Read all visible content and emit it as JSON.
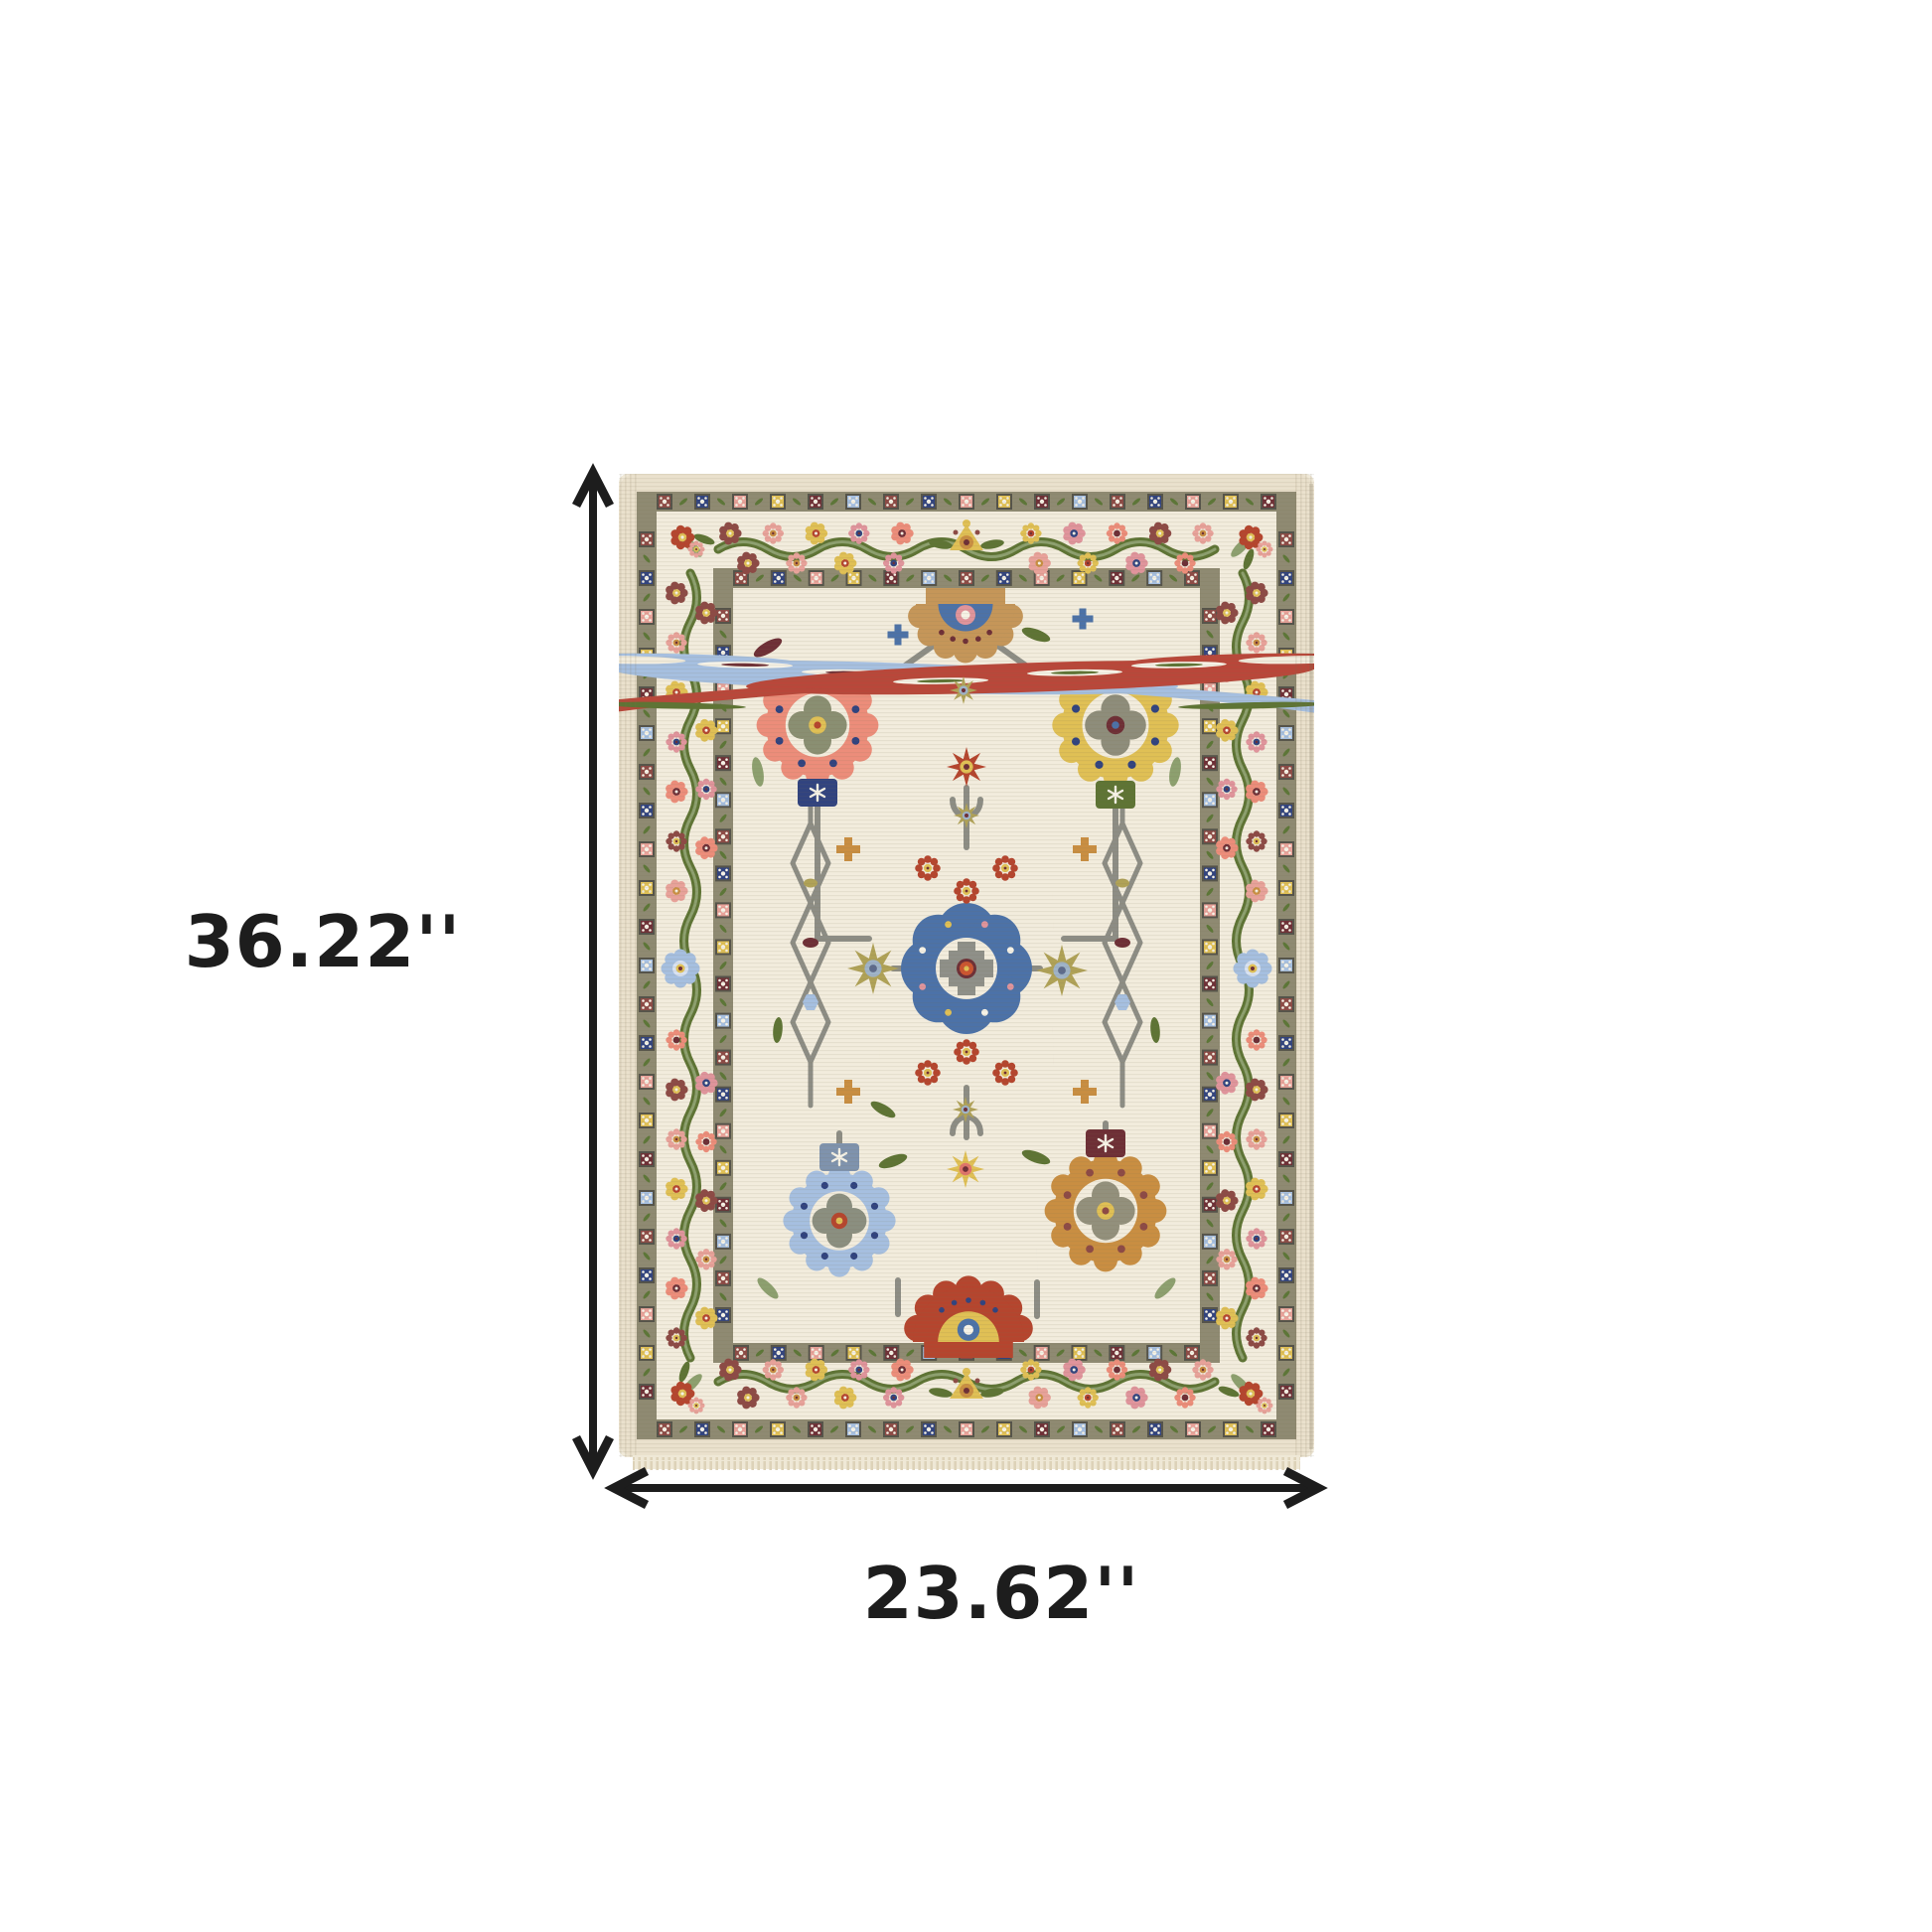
{
  "page": {
    "background": "#ffffff"
  },
  "annotations": {
    "height_label": "36.22''",
    "width_label": "23.62''",
    "arrow_color": "#1d1d1d",
    "label_color": "#1d1d1d"
  },
  "rug": {
    "palette": {
      "ivory": "#f2ecdd",
      "cream": "#f0e9d8",
      "edge": "#eae1cd",
      "guard_band": "#8f8a72",
      "square_frame": "#55534a",
      "vine_green": "#5c7637",
      "sage": "#8da06f",
      "leaf_green": "#5e7434",
      "gray_vine": "#8d8d85",
      "camel": "#c59659",
      "coral": "#ec8d7a",
      "salmon_pink": "#e8a29a",
      "denim_blue": "#4c72a8",
      "navy": "#31437f",
      "periwinkle": "#a6bfe0",
      "gold": "#e0c055",
      "amber": "#c98e42",
      "rust_red": "#b5452e",
      "maroon": "#6e2f36",
      "wine": "#8d4a45",
      "olive_gold": "#b0a257",
      "orange": "#cc5530",
      "pink": "#e0949c",
      "white_accent": "#f6f2e6"
    }
  }
}
